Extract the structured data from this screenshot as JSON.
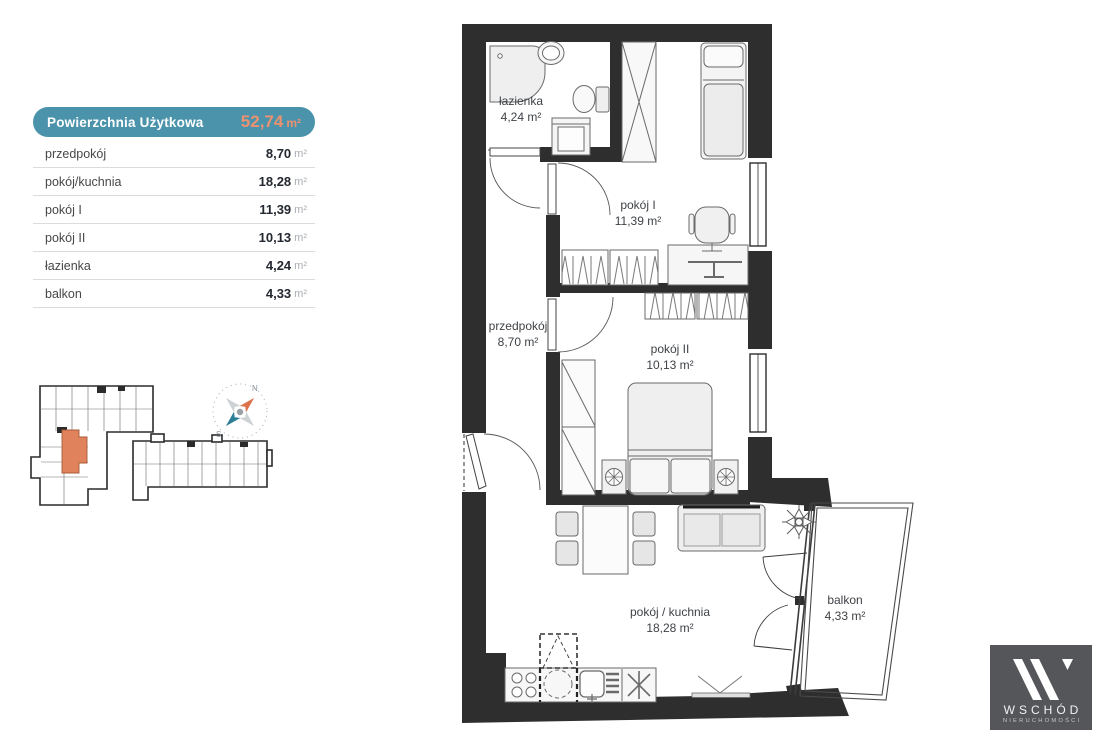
{
  "summary": {
    "title": "Powierzchnia Użytkowa",
    "total_value": "52,74",
    "total_unit": "m²",
    "rows": [
      {
        "label": "przedpokój",
        "value": "8,70",
        "unit": "m²"
      },
      {
        "label": "pokój/kuchnia",
        "value": "18,28",
        "unit": "m²"
      },
      {
        "label": "pokój I",
        "value": "11,39",
        "unit": "m²"
      },
      {
        "label": "pokój II",
        "value": "10,13",
        "unit": "m²"
      },
      {
        "label": "łazienka",
        "value": "4,24",
        "unit": "m²"
      },
      {
        "label": "balkon",
        "value": "4,33",
        "unit": "m²"
      }
    ]
  },
  "compass": {
    "north_label": "N",
    "south_label": "S"
  },
  "plan_rooms": {
    "lazienka": {
      "name": "łazienka",
      "area": "4,24 m²"
    },
    "pokoj1": {
      "name": "pokój I",
      "area": "11,39 m²"
    },
    "przedpokoj": {
      "name": "przedpokój",
      "area": "8,70 m²"
    },
    "pokoj2": {
      "name": "pokój II",
      "area": "10,13 m²"
    },
    "kuchnia": {
      "name": "pokój / kuchnia",
      "area": "18,28 m²"
    },
    "balkon": {
      "name": "balkon",
      "area": "4,33 m²"
    }
  },
  "logo": {
    "brand": "WSCHÓD",
    "tagline": "NIERUCHOMOŚCI"
  },
  "colors": {
    "header_teal": "#4b93ab",
    "accent_orange": "#ec9271",
    "wall_dark": "#2e2e2e",
    "minimap_highlight": "#e0825c",
    "compass_north": "#dd7149",
    "compass_south": "#2d7f97",
    "logo_background": "#54565a"
  }
}
